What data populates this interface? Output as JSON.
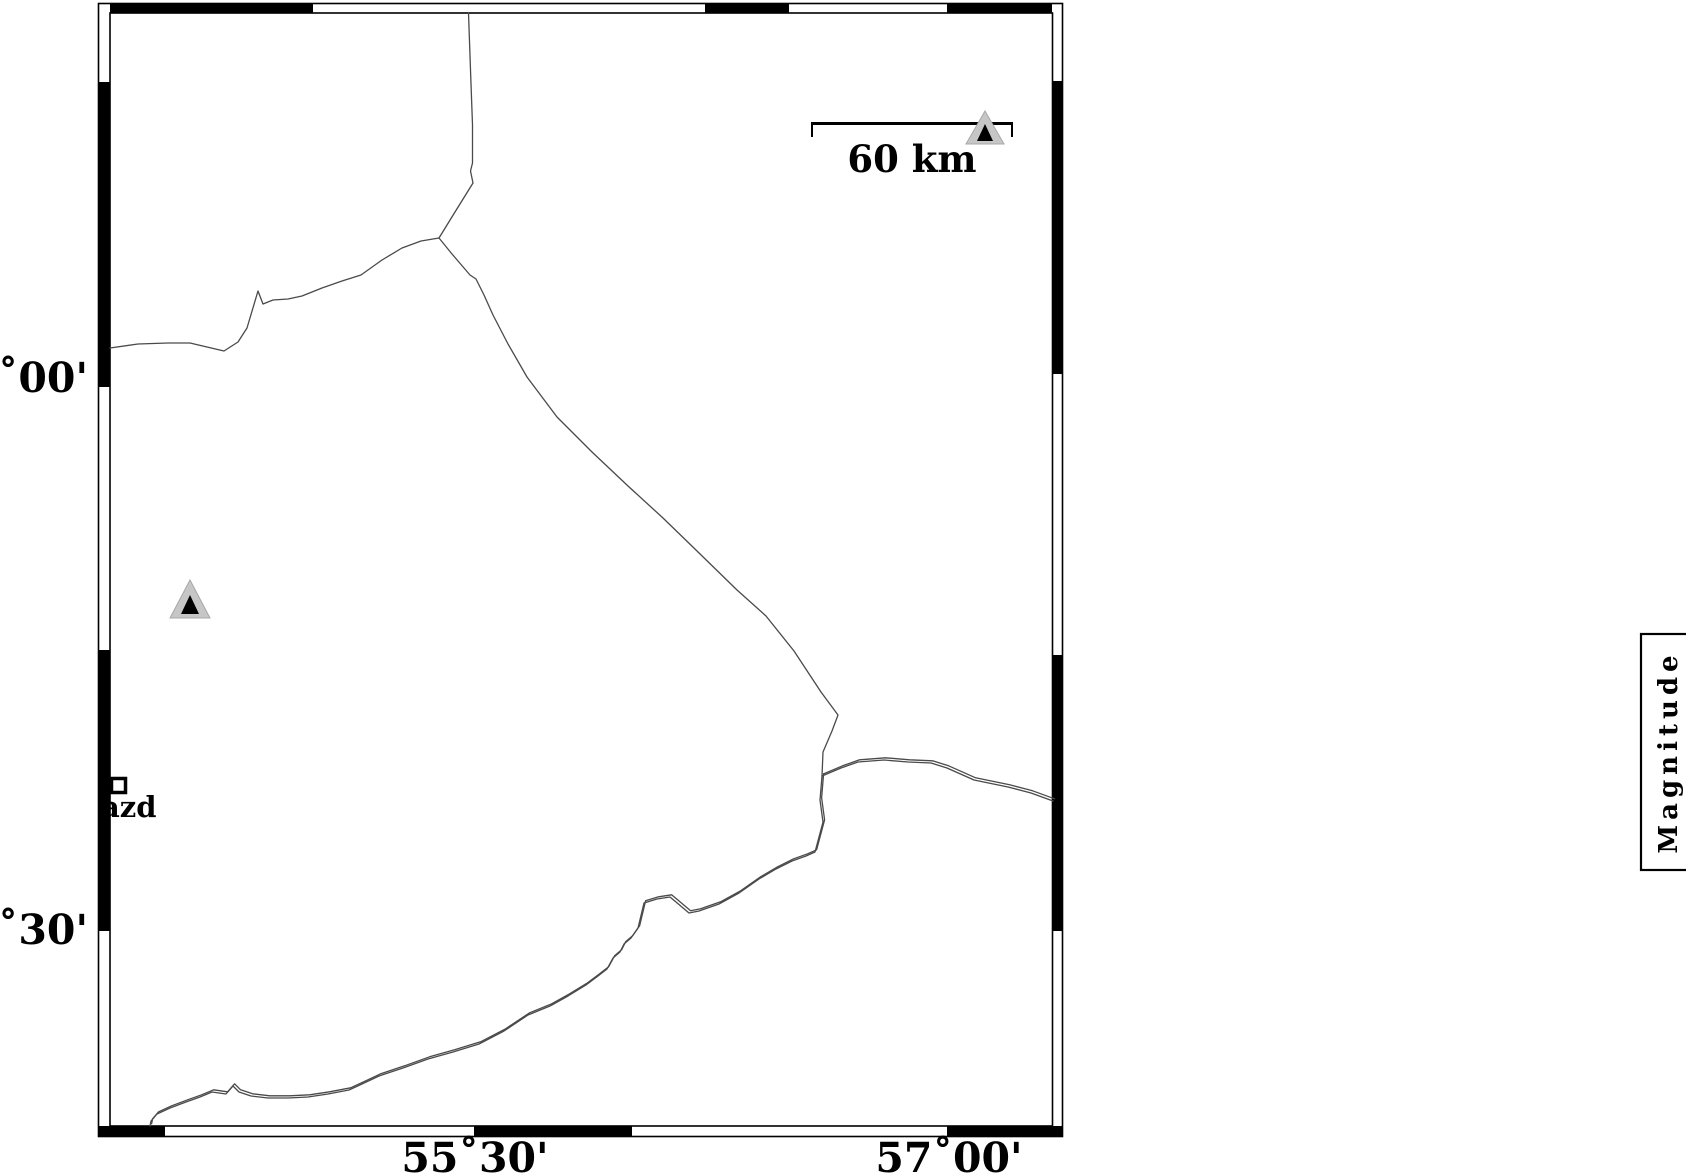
{
  "axes": {
    "left": [
      {
        "label": "33˚00'"
      },
      {
        "label": "31˚30'"
      }
    ],
    "bottom": [
      {
        "label": "55˚30'"
      },
      {
        "label": "57˚00'"
      }
    ]
  },
  "scale_bar": {
    "label": "60 km",
    "length_km": 60
  },
  "stations": {
    "azd": {
      "label": "azd",
      "marker": "open-square"
    }
  },
  "seismometer_markers": [
    {
      "marker": "triangle",
      "x": 190,
      "y": 600
    },
    {
      "marker": "triangle",
      "x": 985,
      "y": 128
    }
  ],
  "legend": {
    "title": "Magnitude"
  },
  "colors": {
    "background": "#ffffff",
    "frame": "#000000",
    "boundary_line": "#4a4a4a",
    "boundary_echo": "#a2a2a2",
    "triangle_fill": "#c6c6c6",
    "triangle_inner": "#000000",
    "text": "#000000"
  }
}
